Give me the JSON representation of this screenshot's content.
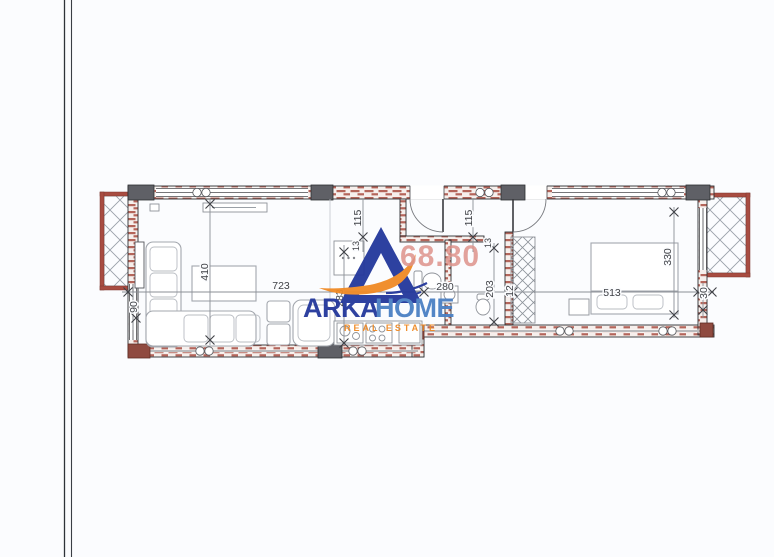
{
  "page": {
    "background": "#fbfcfe",
    "edge_line_color": "#2e3238"
  },
  "plan_colors": {
    "wall_red": "#a84c41",
    "column_gray": "#5f6066",
    "corner_red": "#8f4a40",
    "hatch_gray": "#959ba4",
    "dimension_text": "#3f4146"
  },
  "area_label": {
    "text": "68.80",
    "color": "#de938b"
  },
  "logo": {
    "word_primary": "ARKA",
    "word_secondary": "HOME",
    "tagline": "REAL ESTATE",
    "blue_dark": "#23379b",
    "blue_light": "#4b80c4",
    "orange": "#f08a24"
  },
  "dimensions": {
    "balcony_left": "90",
    "living_width": "723",
    "living_depth": "410",
    "kitchen_depth": "283",
    "left_door_offset": "115",
    "left_door_small": "13",
    "entry_width": "12",
    "hall_width": "280",
    "right_door_offset": "115",
    "right_door_small": "13",
    "corridor_depth": "203",
    "bedroom_width": "513",
    "bedroom_depth": "330",
    "right_jog": "30"
  }
}
